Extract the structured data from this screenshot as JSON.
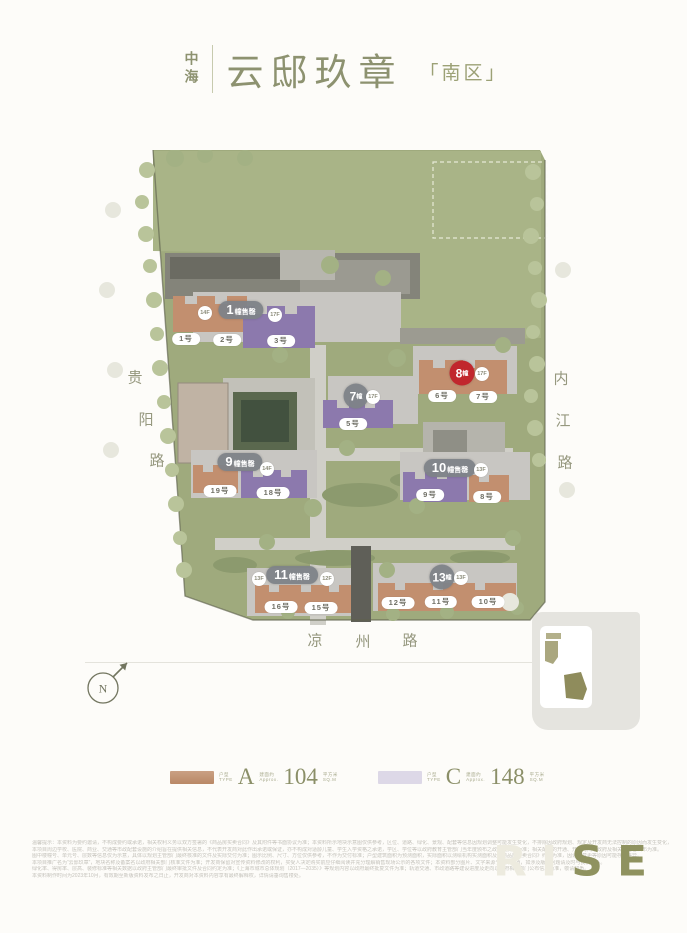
{
  "header": {
    "brand": "中海",
    "title": "云邸玖章",
    "zone": "「南区」"
  },
  "map": {
    "roads": [
      {
        "name": "guiyang-road",
        "chars": [
          "贵",
          "阳",
          "路"
        ]
      },
      {
        "name": "neijiang-road",
        "chars": [
          "内",
          "江",
          "路"
        ]
      },
      {
        "name": "liangzhou-road",
        "chars": [
          "凉",
          "州",
          "路"
        ]
      }
    ],
    "buildings": [
      {
        "num": "1",
        "suffix": "幢售罄",
        "status": "soldout",
        "floors": [
          "14F",
          "17F"
        ],
        "units": [
          "1号",
          "2号",
          "3号"
        ]
      },
      {
        "num": "7",
        "suffix": "幢",
        "status": "onsale",
        "floors": [
          "17F"
        ],
        "units": [
          "5号"
        ]
      },
      {
        "num": "8",
        "suffix": "幢",
        "status": "highlight",
        "floors": [
          "17F"
        ],
        "units": [
          "6号",
          "7号"
        ]
      },
      {
        "num": "9",
        "suffix": "幢售罄",
        "status": "soldout",
        "floors": [
          "14F"
        ],
        "units": [
          "19号",
          "18号"
        ]
      },
      {
        "num": "10",
        "suffix": "幢售罄",
        "status": "soldout",
        "floors": [
          "13F"
        ],
        "units": [
          "9号",
          "8号"
        ]
      },
      {
        "num": "11",
        "suffix": "幢售罄",
        "status": "soldout",
        "floors": [
          "13F",
          "12F"
        ],
        "units": [
          "16号",
          "15号"
        ]
      },
      {
        "num": "13",
        "suffix": "幢",
        "status": "onsale",
        "floors": [
          "13F"
        ],
        "units": [
          "12号",
          "11号",
          "10号"
        ]
      }
    ],
    "compass": "N"
  },
  "legend": {
    "items": [
      {
        "letter": "A",
        "value": "104",
        "type_cn": "户型",
        "type_en": "TYPE",
        "approx_cn": "建面约",
        "approx_en": "Approx.",
        "unit_cn": "平方米",
        "unit_en": "SQ.M",
        "swatch": "#c4926f"
      },
      {
        "letter": "C",
        "value": "148",
        "type_cn": "户型",
        "type_en": "TYPE",
        "approx_cn": "建面约",
        "approx_en": "Approx.",
        "unit_cn": "平方米",
        "unit_en": "SQ.M",
        "swatch": "#ddd8e7"
      }
    ]
  },
  "disclaimer": {
    "lines": [
      "温馨提示：本资料为要约邀请，不构成要约或承诺，相关权利义务以双方签署的《商品房买卖合同》及其附件等书面协议为准；本资料所示地块示意图仅供参考，区位、道路、绿化、景观、配套等信息因规划调整可能发生变化，不排除因政府规划、规定及开发商无法控制的原因而发生变化，敬请留意最新资料。",
      "本项目周边学校、医院、商业、交通等市政配套设施的介绍旨在提供相关信息，不代表开发商对此作出承诺或保证，亦不构成对适龄儿童、学生入学资格之承诺，学区、学位等以政府教育主管部门当年度颁布之政策及安排为准；相关配套的开通、开业时间以政府及相关经营者公布为准。",
      "图中楼幢号、单元号、层数等信息仅为示意，具体以规划主管部门最终核准的文件及实际交付为准；图示比例、尺寸、方位仅供参考，不作为交付标准；户型建筑面积为预测面积，实际面积以测绘机构实测面积及《商品房买卖合同》约定为准，因设计变更等原因可能存在差异。",
      "本项目推广名为“云邸玖章”，地块名称及备案名以政府相关部门核准文件为准；开发商保留对宣传资料修改的权利，买受人决定购买前应仔细阅读并充分理解销售现场公示的各项文件；本资料部分图片、文字来源于公开渠道，如涉及版权问题请及时与我们联系。",
      "绿化率、得房率、层高、装修标准等相关数据以政府主管部门最终审批文件及合同约定为准；《上海市城市总体规划（2017—2035）》等规划内容以政府最终批复文件为准；轨道交通、市政道路等建设进度及走向以政府相关部门公布信息为准，敬请知悉。",
      "本资料制作时间为2023年10月，有效期至新版资料发布之日止，开发商对本资料内容享有最终解释权，详情请垂询售楼处。"
    ]
  },
  "watermark": {
    "faint": "RI",
    "solid": "SE"
  },
  "colors": {
    "accent_olive": "#8b8f6a",
    "tan": "#c28f6f",
    "purple": "#8c79ad",
    "red_badge": "#c1272d",
    "lawn": "#a9b487",
    "site_green": "#9faa7d"
  }
}
